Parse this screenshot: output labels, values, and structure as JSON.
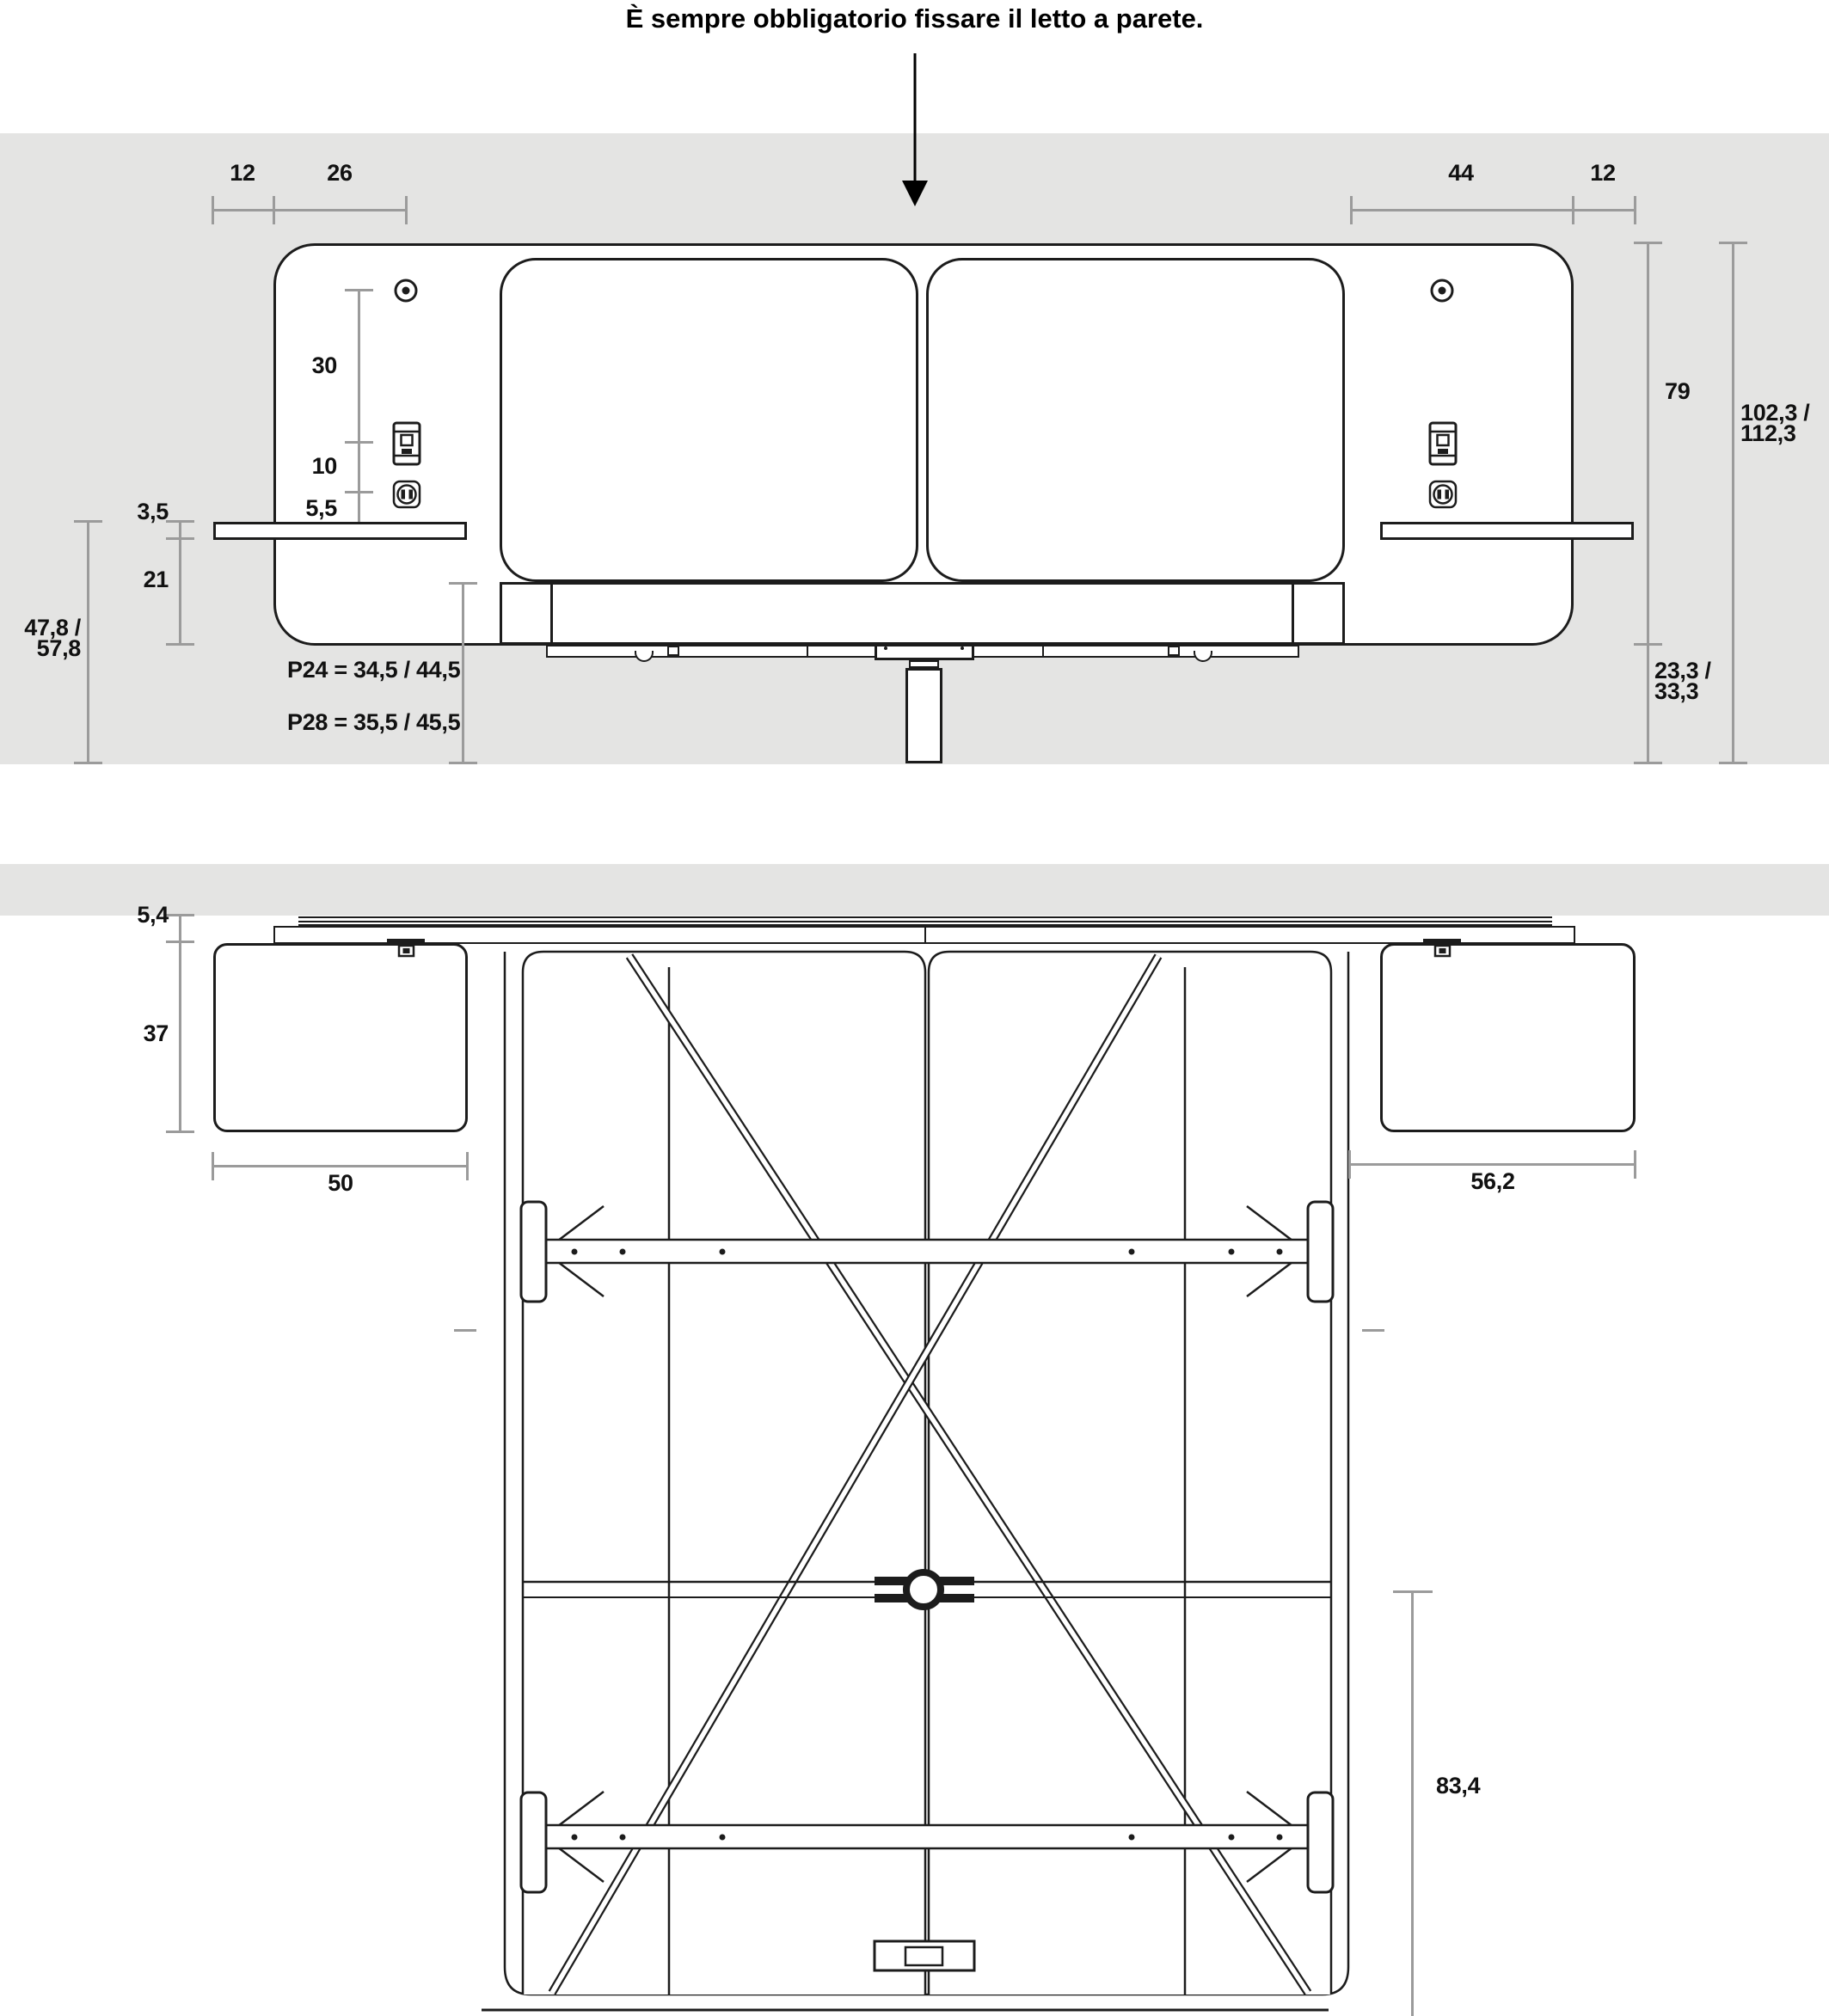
{
  "title": "È sempre obbligatorio fissare il letto a parete.",
  "colors": {
    "wall": "#e4e4e3",
    "line": "#1c1c1c",
    "dim_line": "#9b9b9b",
    "text": "#111111",
    "background": "#ffffff"
  },
  "icons": {
    "wall_arrow": "filled-down-arrow",
    "fixing_screw": "concentric-circles",
    "switch": "rocker-switch-plate",
    "outlet": "schuko-power-socket",
    "leg_foot": "ring-circle",
    "fixing_bracket": "t-bracket"
  },
  "front_view": {
    "dims": {
      "shelf_overhang_left": "12",
      "edge_to_fixing": "26",
      "mattress_to_edge": "44",
      "shelf_overhang_right": "12",
      "fixing_to_switch": "30",
      "switch_to_outlet": "10",
      "outlet_to_shelf": "5,5",
      "shelf_thickness": "3,5",
      "shelf_to_frame_bottom": "21",
      "floor_to_shelf_line1": "47,8 /",
      "floor_to_shelf_line2": "57,8",
      "headboard_height": "79",
      "total_height_line1": "102,3 /",
      "total_height_line2": "112,3",
      "frame_clearance_line1": "23,3 /",
      "frame_clearance_line2": "33,3",
      "platform_height_p24": "P24 = 34,5 / 44,5",
      "platform_height_p28": "P28 = 35,5 / 45,5"
    }
  },
  "top_view": {
    "dims": {
      "headboard_depth": "5,4",
      "nightstand_depth": "37",
      "nightstand_width_left": "50",
      "nightstand_width_right": "56,2",
      "rail_to_foot": "83,4"
    }
  }
}
